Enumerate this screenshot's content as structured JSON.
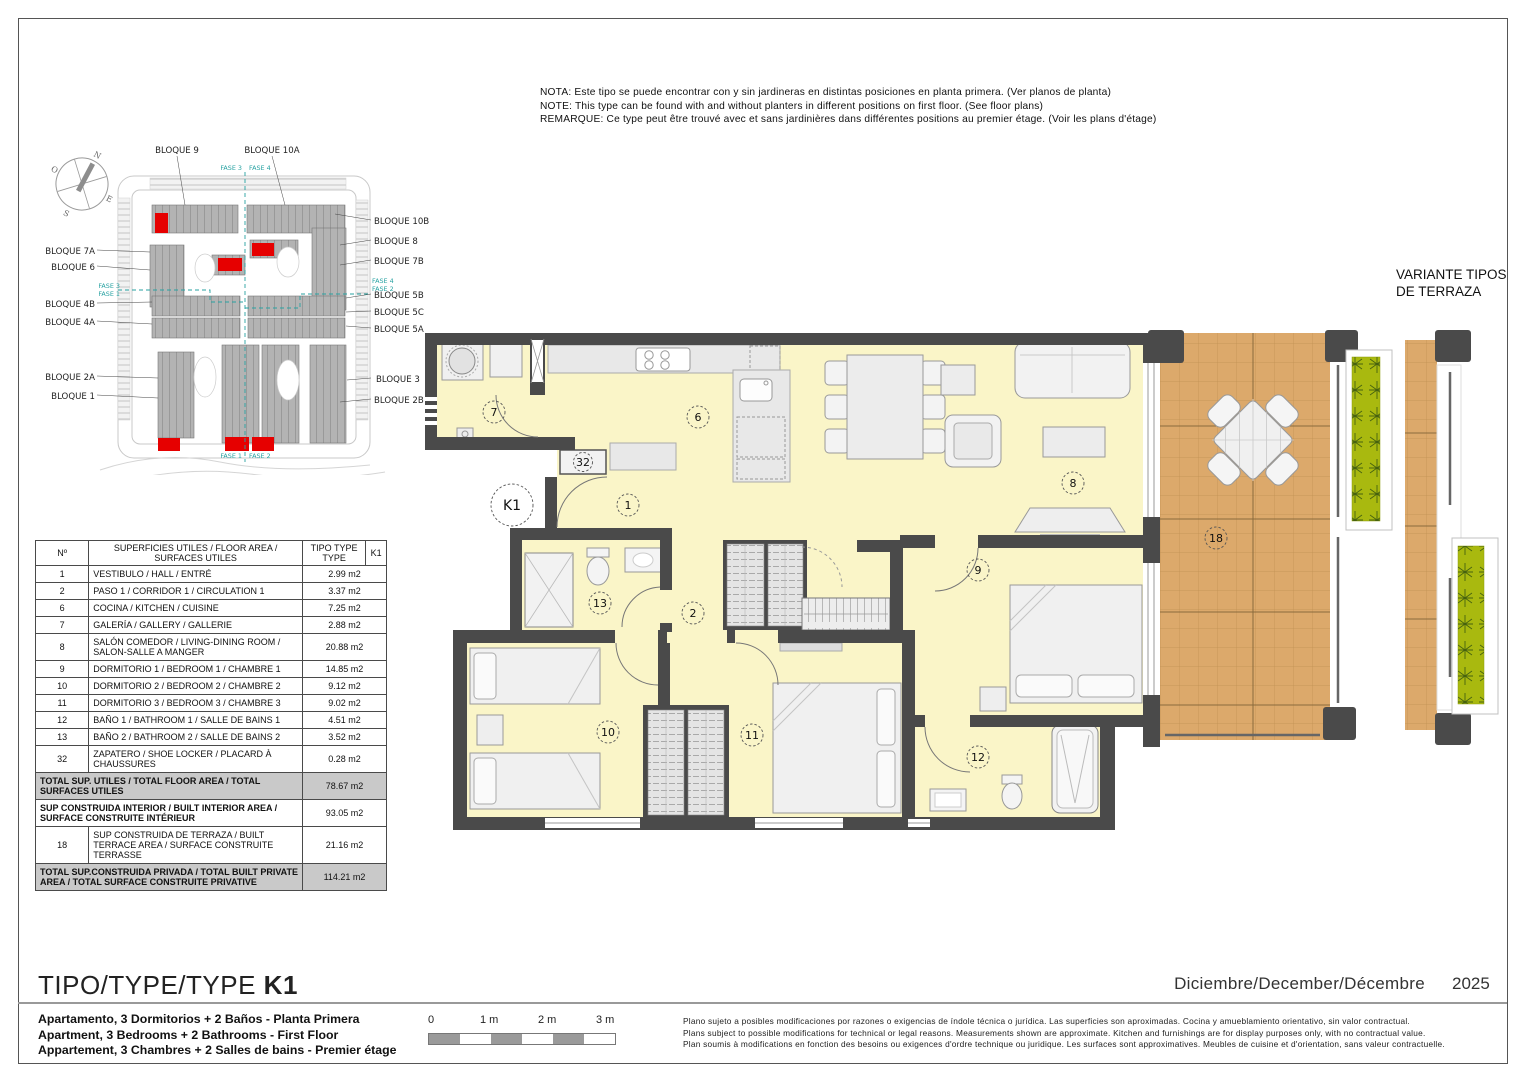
{
  "note": {
    "line1": "NOTA: Este tipo se puede encontrar con y sin jardineras en distintas posiciones en planta primera. (Ver planos de planta)",
    "line2": "NOTE: This type can be found with and without planters in different positions on first floor. (See floor plans)",
    "line3": "REMARQUE: Ce type peut être trouvé avec et sans jardinières dans différentes positions au premier étage. (Voir les plans d'étage)"
  },
  "site_plan": {
    "compass": {
      "n": "N",
      "o": "O",
      "s": "S",
      "e": "E"
    },
    "b9": "BLOQUE 9",
    "b10a": "BLOQUE 10A",
    "b10b": "BLOQUE 10B",
    "b8": "BLOQUE 8",
    "b7b": "BLOQUE 7B",
    "b5b": "BLOQUE 5B",
    "b5c": "BLOQUE 5C",
    "b5a": "BLOQUE 5A",
    "b3": "BLOQUE 3",
    "b2b": "BLOQUE 2B",
    "b7a": "BLOQUE 7A",
    "b6": "BLOQUE 6",
    "b4b": "BLOQUE 4B",
    "b4a": "BLOQUE 4A",
    "b2a": "BLOQUE 2A",
    "b1": "BLOQUE 1",
    "fase1": "FASE 1",
    "fase2": "FASE 2",
    "fase3": "FASE 3",
    "fase4": "FASE 4",
    "highlight_color": "#e60000"
  },
  "area_table": {
    "header": {
      "col_no": "Nº",
      "col_desc": "SUPERFICIES UTILES / FLOOR AREA / SURFACES UTILES",
      "col_type": "TIPO TYPE TYPE",
      "col_k1": "K1"
    },
    "rows": [
      {
        "no": "1",
        "label": "VESTIBULO / HALL / ENTRÉ",
        "value": "2.99 m2"
      },
      {
        "no": "2",
        "label": "PASO 1 / CORRIDOR 1 / CIRCULATION 1",
        "value": "3.37 m2"
      },
      {
        "no": "6",
        "label": "COCINA / KITCHEN / CUISINE",
        "value": "7.25 m2"
      },
      {
        "no": "7",
        "label": "GALERÍA / GALLERY / GALLERIE",
        "value": "2.88 m2"
      },
      {
        "no": "8",
        "label": "SALÓN COMEDOR  / LIVING-DINING ROOM / SALON-SALLE A MANGER",
        "value": "20.88 m2"
      },
      {
        "no": "9",
        "label": "DORMITORIO 1 / BEDROOM 1 / CHAMBRE 1",
        "value": "14.85 m2"
      },
      {
        "no": "10",
        "label": "DORMITORIO 2 / BEDROOM 2 / CHAMBRE 2",
        "value": "9.12 m2"
      },
      {
        "no": "11",
        "label": "DORMITORIO 3 / BEDROOM 3 / CHAMBRE 3",
        "value": "9.02 m2"
      },
      {
        "no": "12",
        "label": "BAÑO 1 / BATHROOM 1 / SALLE DE BAINS 1",
        "value": "4.51 m2"
      },
      {
        "no": "13",
        "label": "BAÑO 2 / BATHROOM 2 / SALLE DE BAINS 2",
        "value": "3.52 m2"
      },
      {
        "no": "32",
        "label": "ZAPATERO / SHOE LOCKER / PLACARD À CHAUSSURES",
        "value": "0.28 m2"
      }
    ],
    "total_utiles": {
      "label": "TOTAL SUP. UTILES / TOTAL FLOOR AREA / TOTAL SURFACES UTILES",
      "value": "78.67 m2"
    },
    "built_interior": {
      "label": "SUP CONSTRUIDA INTERIOR / BUILT INTERIOR AREA / SURFACE CONSTRUITE INTÉRIEUR",
      "value": "93.05 m2"
    },
    "terrace_row": {
      "no": "18",
      "label": "SUP CONSTRUIDA  DE TERRAZA  / BUILT TERRACE  AREA / SURFACE CONSTRUITE TERRASSE",
      "value": "21.16 m2"
    },
    "total_private": {
      "label": "TOTAL SUP.CONSTRUIDA PRIVADA / TOTAL  BUILT PRIVATE AREA / TOTAL SURFACE CONSTRUITE PRIVATIVE",
      "value": "114.21 m2"
    }
  },
  "floor_plan": {
    "type_label": "K1",
    "room_numbers": {
      "hall": "1",
      "corridor": "2",
      "kitchen": "6",
      "gallery": "7",
      "living": "8",
      "bedroom1": "9",
      "bedroom2": "10",
      "bedroom3": "11",
      "bath1": "12",
      "bath2": "13",
      "terrace": "18",
      "shoe_locker": "32"
    }
  },
  "variant": {
    "title1": "VARIANTE TIPOS",
    "title2": "DE TERRAZA"
  },
  "title_block": {
    "title": "TIPO/TYPE/TYPE",
    "type_code": "K1",
    "desc_es": "Apartamento, 3 Dormitorios + 2 Baños - Planta Primera",
    "desc_en": "Apartment, 3 Bedrooms + 2 Bathrooms - First Floor",
    "desc_fr": "Appartement, 3 Chambres + 2 Salles de bains - Premier étage",
    "date": "Diciembre/December/Décembre",
    "year": "2025"
  },
  "scale_bar": {
    "labels": [
      "0",
      "1 m",
      "2 m",
      "3 m"
    ]
  },
  "disclaimer": {
    "line_es": "Plano sujeto a posibles modificaciones por razones o exigencias de índole técnica o jurídica. Las superficies son aproximadas. Cocina y amueblamiento orientativo, sin valor contractual.",
    "line_en": "Plans subject to possible modifications for technical or legal reasons. Measurements shown are approximate. Kitchen and furnishings are for display purposes only, with no contractual value.",
    "line_fr": "Plan soumis à modifications en fonction des besoins ou exigences d'ordre technique ou juridique. Les surfaces sont approximatives. Meubles de cuisine et d'orientation, sans valeur contractuelle."
  },
  "colors": {
    "wall": "#4a4a4a",
    "floor": "#faf5c8",
    "terrace": "#dca96b",
    "planter": "#a9b90f",
    "highlight": "#e60000",
    "phase_line": "#27a2a2",
    "table_total_bg": "#c9c9c9"
  }
}
